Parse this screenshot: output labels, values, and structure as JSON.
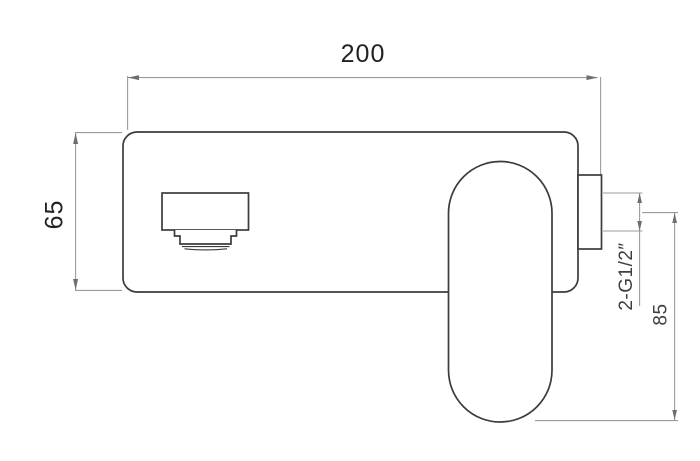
{
  "drawing": {
    "description": "Wall-mounted basin mixer tap technical drawing, front view with dimensions",
    "dimensions": {
      "width_label": "200",
      "height_label": "65",
      "thread_label": "2-G1/2″",
      "depth_label": "85"
    },
    "colors": {
      "background": "#ffffff",
      "object_line": "#3c3c3c",
      "dimension_line": "#9b9b9b",
      "label_text": "#222222"
    }
  }
}
